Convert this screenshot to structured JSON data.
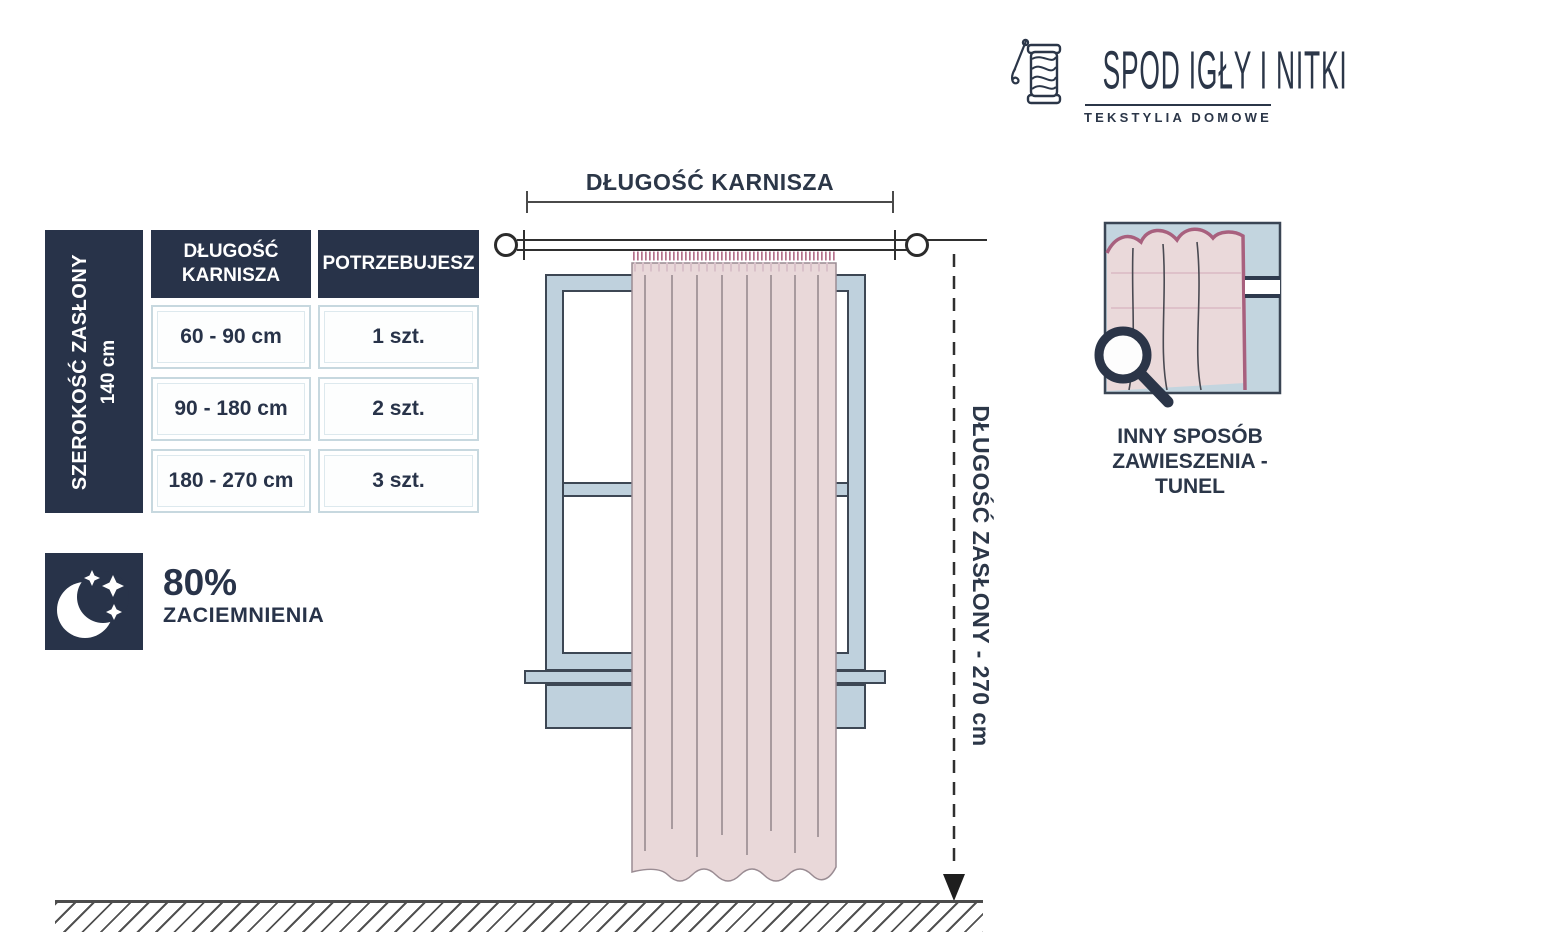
{
  "colors": {
    "navy": "#283349",
    "window_blue": "#bfd1dd",
    "table_border_blue": "#c7d8df",
    "curtain_pink": "#e9d8d9",
    "curtain_edge_mauve": "#a8607e",
    "line_dark": "#2f2f2f"
  },
  "logo": {
    "icon": "needle-and-yarn-spool-icon",
    "title": "SPOD IGŁY I NITKI",
    "subtitle": "TEKSTYLIA DOMOWE"
  },
  "size_table": {
    "side_label_line1": "SZEROKOŚĆ ZASŁONY",
    "side_label_line2": "140 cm",
    "columns": [
      "DŁUGOŚĆ KARNISZA",
      "POTRZEBUJESZ"
    ],
    "rows": [
      {
        "range": "60 - 90 cm",
        "qty": "1 szt."
      },
      {
        "range": "90 - 180 cm",
        "qty": "2 szt."
      },
      {
        "range": "180 - 270 cm",
        "qty": "3 szt."
      }
    ]
  },
  "blackout": {
    "icon": "moon-and-stars-icon",
    "value": "80%",
    "label": "ZACIEMNIENIA"
  },
  "diagram": {
    "rod_length_label": "DŁUGOŚĆ KARNISZA",
    "curtain_length_label": "DŁUGOŚĆ ZASŁONY - 270 cm"
  },
  "alt_hanging": {
    "icon": "magnifier-icon",
    "caption_line1": "INNY SPOSÓB",
    "caption_line2": "ZAWIESZENIA - TUNEL"
  }
}
